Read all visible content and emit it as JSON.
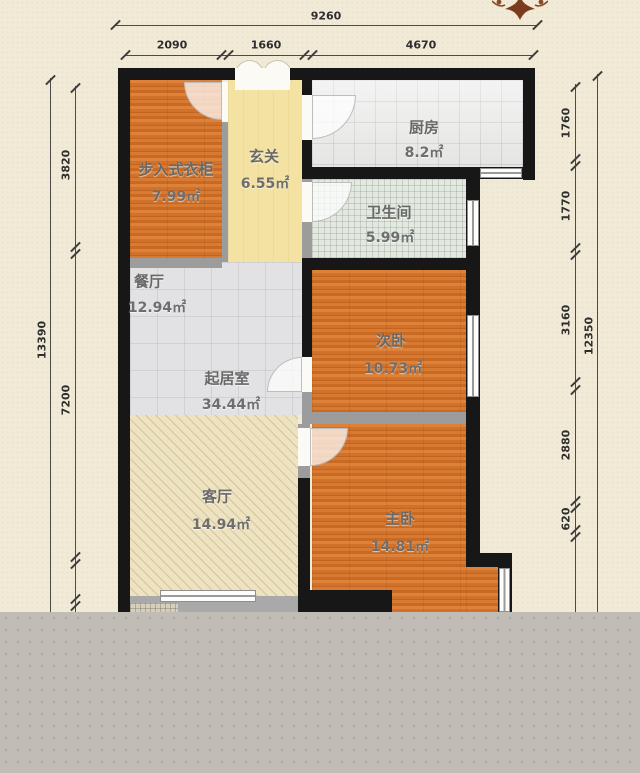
{
  "plan_title": "residential-floor-plan",
  "rooms": [
    {
      "id": "closet",
      "name": "步入式衣柜",
      "area": "7.99㎡"
    },
    {
      "id": "hallway",
      "name": "玄关",
      "area": "6.55㎡"
    },
    {
      "id": "kitchen",
      "name": "厨房",
      "area": "8.2㎡"
    },
    {
      "id": "bathroom",
      "name": "卫生间",
      "area": "5.99㎡"
    },
    {
      "id": "dining",
      "name": "餐厅",
      "area": "12.94㎡"
    },
    {
      "id": "living",
      "name": "起居室",
      "area": "34.44㎡"
    },
    {
      "id": "bedroom2",
      "name": "次卧",
      "area": "10.73㎡"
    },
    {
      "id": "parlor",
      "name": "客厅",
      "area": "14.94㎡"
    },
    {
      "id": "master",
      "name": "主卧",
      "area": "14.81㎡"
    }
  ],
  "dims": {
    "top": {
      "total": "9260",
      "segments": [
        "2090",
        "1660",
        "4670"
      ]
    },
    "left": {
      "total": "13390",
      "segments": [
        "3820",
        "7200"
      ]
    },
    "right": {
      "total": "12350",
      "segments": [
        "1760",
        "1770",
        "3160",
        "2880",
        "620"
      ]
    }
  },
  "colors": {
    "background": "#f1ead7",
    "exterior_wall": "#171717",
    "interior_wall": "#9c9c9c",
    "wood_floor": "#d0722b",
    "hall_floor": "#f3e2a2",
    "tile_floor": "#e2e2e4",
    "hatch_floor": "#eee3c1",
    "crop_overlay": "#c1bdb6",
    "ornament": "#7a3b1e"
  }
}
